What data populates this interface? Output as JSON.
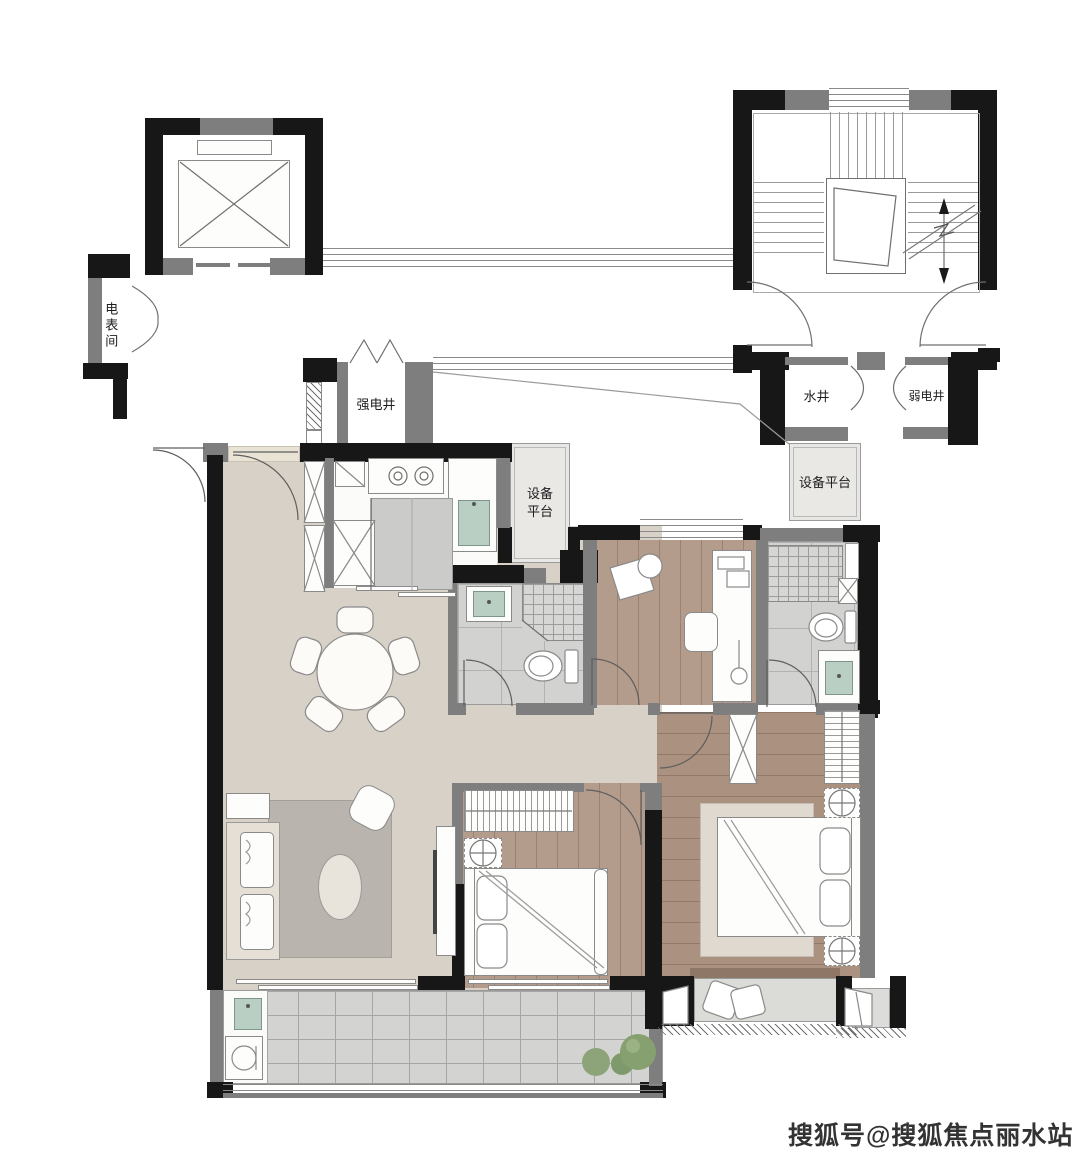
{
  "plan": {
    "type": "apartment-floor-plan",
    "labels": {
      "meter_room": "电表间",
      "strong_electric_shaft": "强电井",
      "water_shaft": "水井",
      "weak_electric_shaft": "弱电井",
      "equipment_platform_left": "设备\n平台",
      "equipment_platform_right": "设备平台"
    },
    "watermark": {
      "text": "搜狐号@搜狐焦点丽水站",
      "color": "#333333"
    },
    "colors": {
      "wall_black": "#171717",
      "wall_gray": "#7e7e7e",
      "floor_living": "#d8d1c7",
      "floor_wood_bedroom": "#b49c8c",
      "floor_wood_master": "#ab917f",
      "floor_tile": "#d2d2d0",
      "floor_balcony": "#d3d3d1",
      "platform_gray": "#e9e8e5",
      "sink_green": "#b9cfc3",
      "plant_green": "#80996c",
      "rug_living": "#b9b5ae",
      "rug_master": "#e0d9cf"
    },
    "symbols": {
      "elevator": "crossed-box",
      "stairs": "treads-with-direction-arrow",
      "door": "quarter-arc-swing",
      "shaft_cabinet": "x-box",
      "window": "parallel-lines"
    }
  }
}
